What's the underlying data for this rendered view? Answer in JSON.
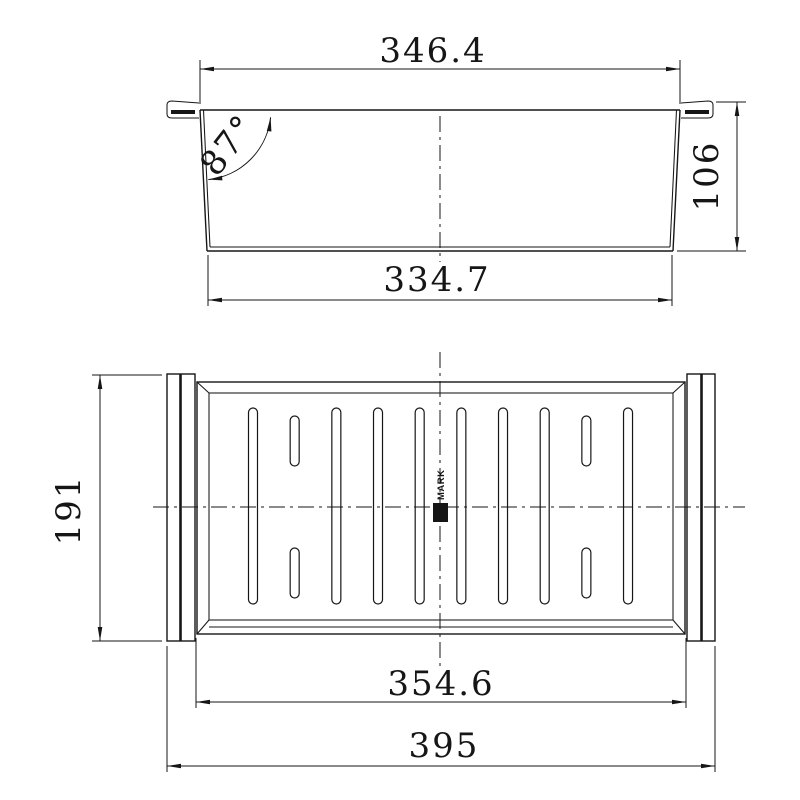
{
  "drawing": {
    "kind": "technical-drawing",
    "background": "#ffffff",
    "line_color": "#161616"
  },
  "front_view": {
    "dim_top_width": "346.4",
    "dim_bottom_width": "334.7",
    "dim_height": "106",
    "dim_wall_angle": "87°"
  },
  "plan_view": {
    "dim_depth": "191",
    "dim_inner_width": "354.6",
    "dim_overall_width": "395",
    "brand_text": "MARK",
    "slots": {
      "first_center_x": 253,
      "step_x": 41.67,
      "pattern": [
        "long",
        "short",
        "long",
        "long",
        "long",
        "long",
        "long",
        "long",
        "short",
        "long"
      ],
      "long": {
        "y": 408,
        "height": 196,
        "width": 9
      },
      "short_top": {
        "y": 416,
        "height": 50,
        "width": 9
      },
      "short_bottom": {
        "y": 548,
        "height": 50,
        "width": 9
      }
    }
  }
}
